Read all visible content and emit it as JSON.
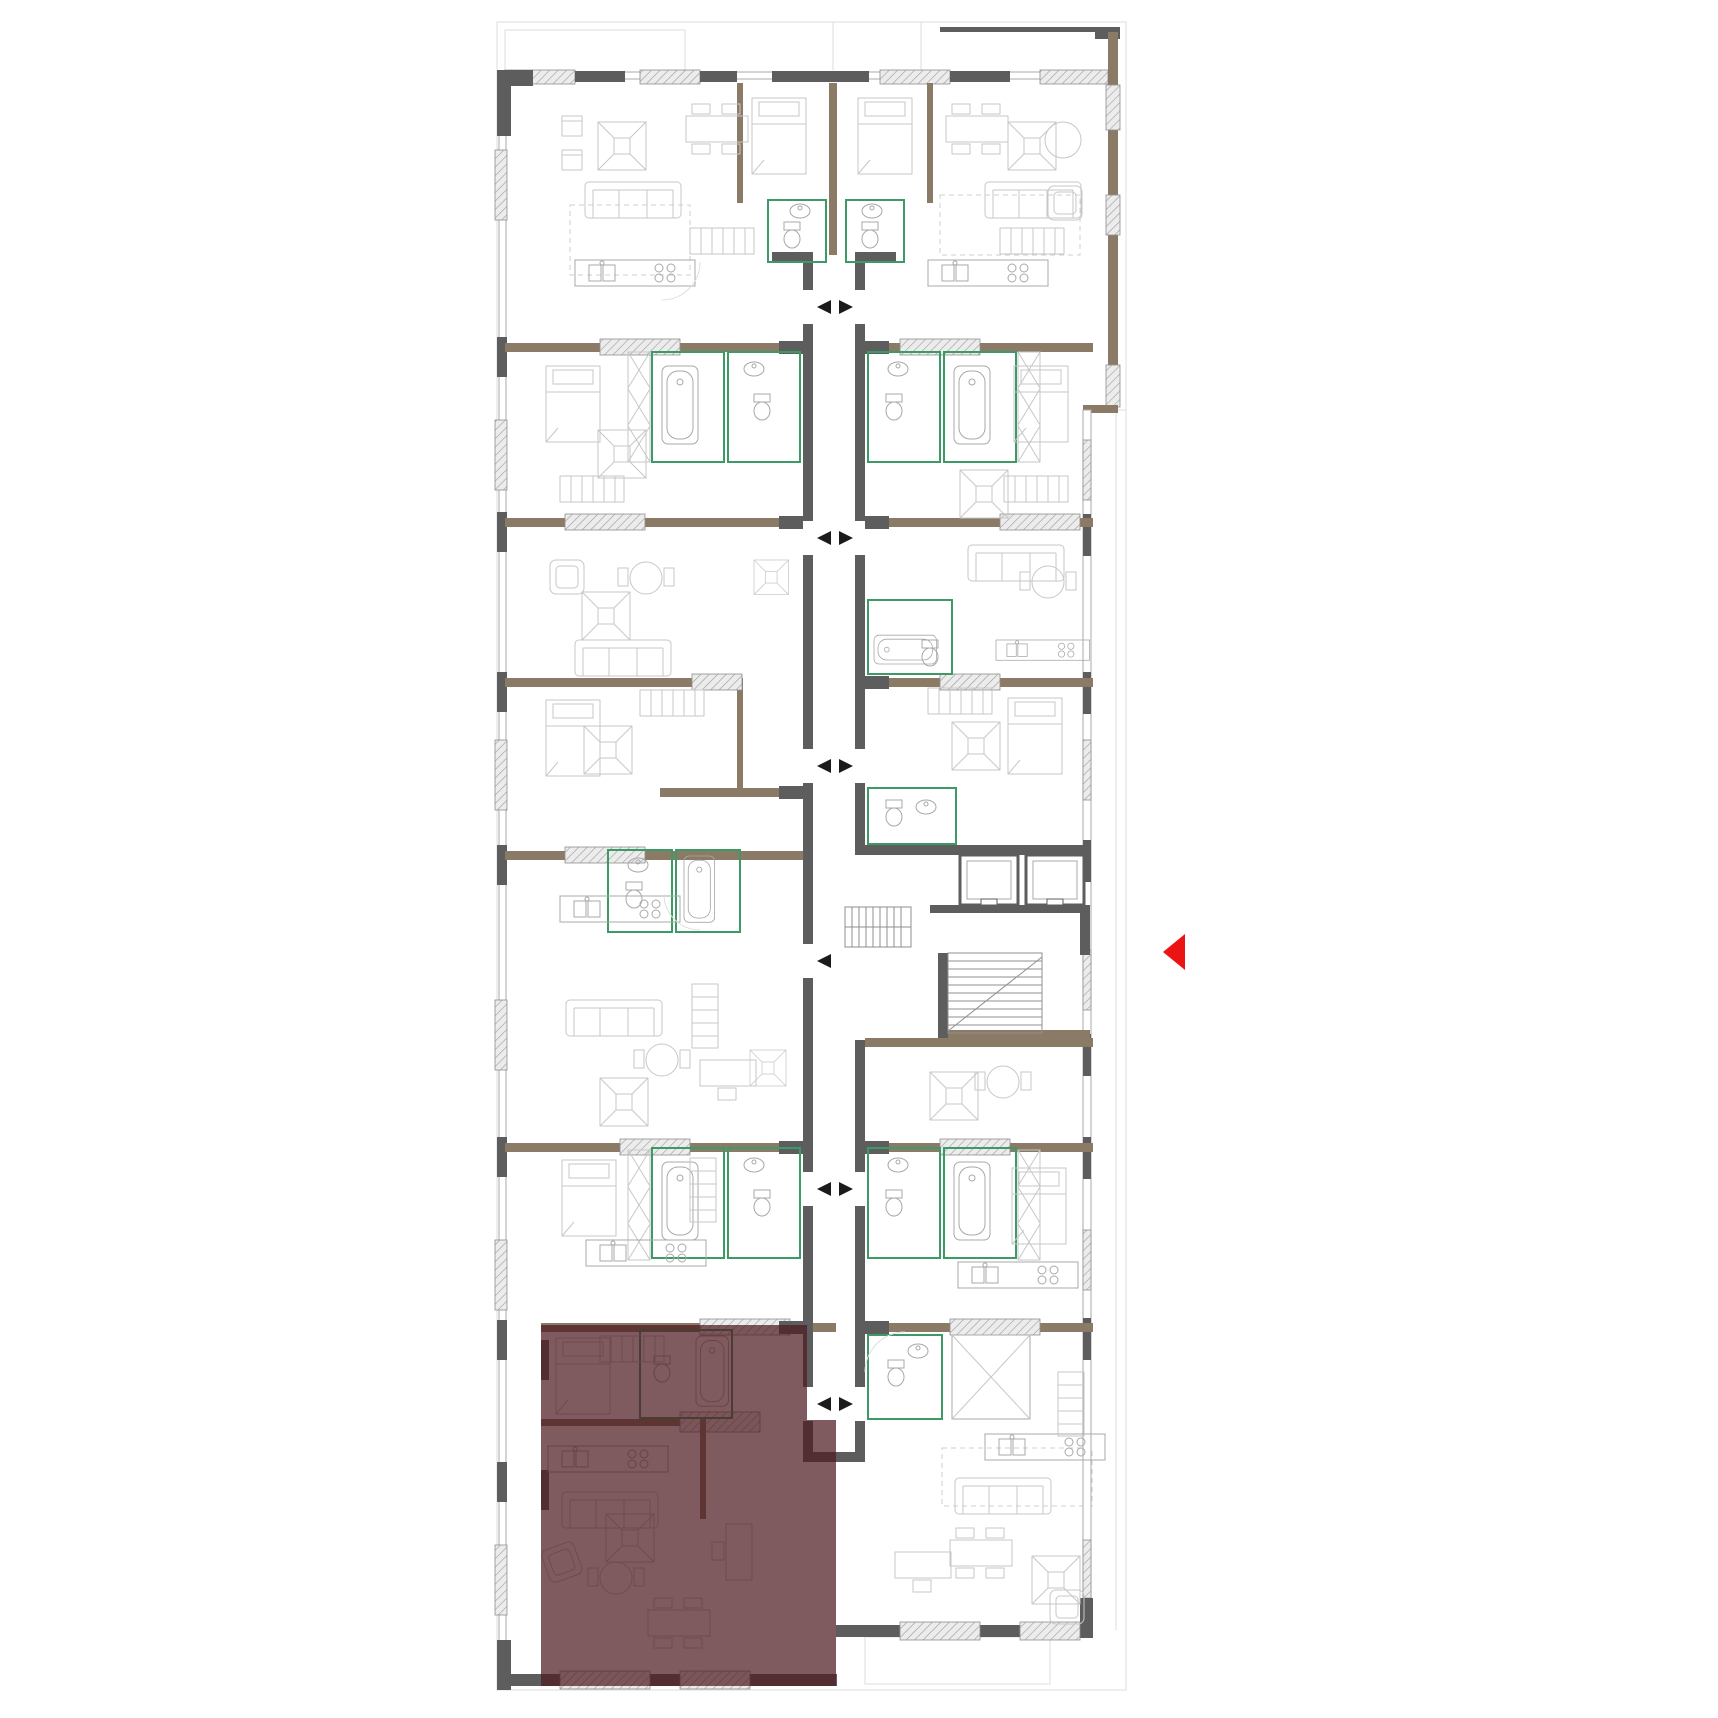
{
  "floor_plan": {
    "description": "building-storey-plan",
    "highlighted_unit": {
      "points": "541,1325 807,1325 807,1420 836,1420 836,1686 541,1686",
      "fill": "#4d1b20",
      "opacity": "0.72"
    },
    "entrance_marker": {
      "shape": "triangle-left",
      "points": "1185,934 1185,970 1163,952",
      "fill": "#ec1313"
    },
    "corridor_arrows": [
      {
        "y": 307,
        "left": true,
        "right": true
      },
      {
        "y": 538,
        "left": true,
        "right": true
      },
      {
        "y": 766,
        "left": true,
        "right": true
      },
      {
        "y": 961,
        "left": true,
        "right": false
      },
      {
        "y": 1189,
        "left": true,
        "right": true
      },
      {
        "y": 1404,
        "left": true,
        "right": true
      }
    ],
    "arrow_geometry": {
      "half_height": 7,
      "left_base_x": 831,
      "left_tip_x": 817,
      "right_base_x": 839,
      "right_tip_x": 853
    },
    "colors": {
      "background": "#ffffff",
      "outline_faint": "#dedede",
      "wall_dark": "#5d5d5d",
      "wall_taupe": "#8b7b66",
      "hatch_fill": "#ececec",
      "hatch_line": "#9a9a9a",
      "furniture_light": "#c7c7c7",
      "furniture_medium": "#a8a8a8",
      "bathroom_green": "#3c9a66",
      "arrow_black": "#1b1b1b",
      "highlight_maroon": "#4d1b20",
      "marker_red": "#ec1313"
    }
  }
}
